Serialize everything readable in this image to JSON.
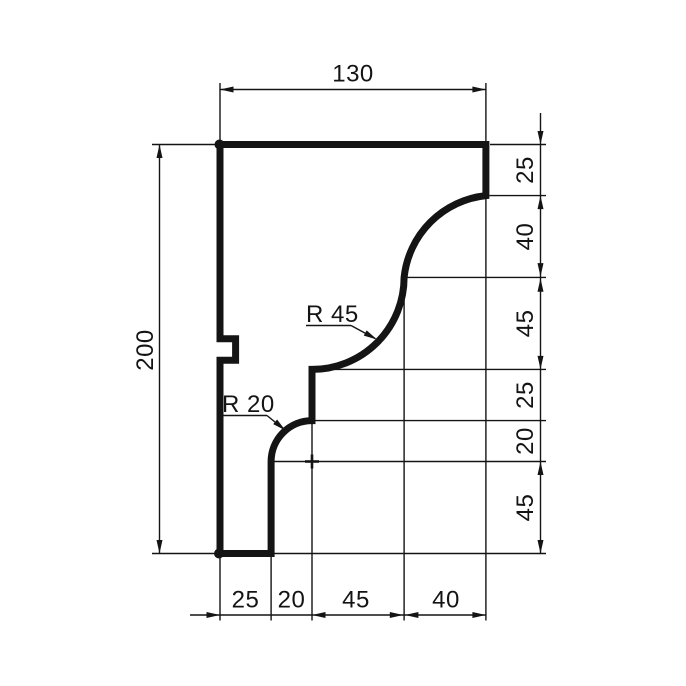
{
  "drawing": {
    "kind": "dimensioned profile cross-section",
    "colors": {
      "line": "#141414",
      "background": "#ffffff"
    },
    "dimensions": {
      "top": "130",
      "left": "200",
      "right": [
        "25",
        "40",
        "45",
        "25",
        "20",
        "45"
      ],
      "bottom": [
        "25",
        "20",
        "45",
        "40"
      ]
    },
    "radius_labels": {
      "r45": "R 45",
      "r20": "R 20"
    }
  }
}
